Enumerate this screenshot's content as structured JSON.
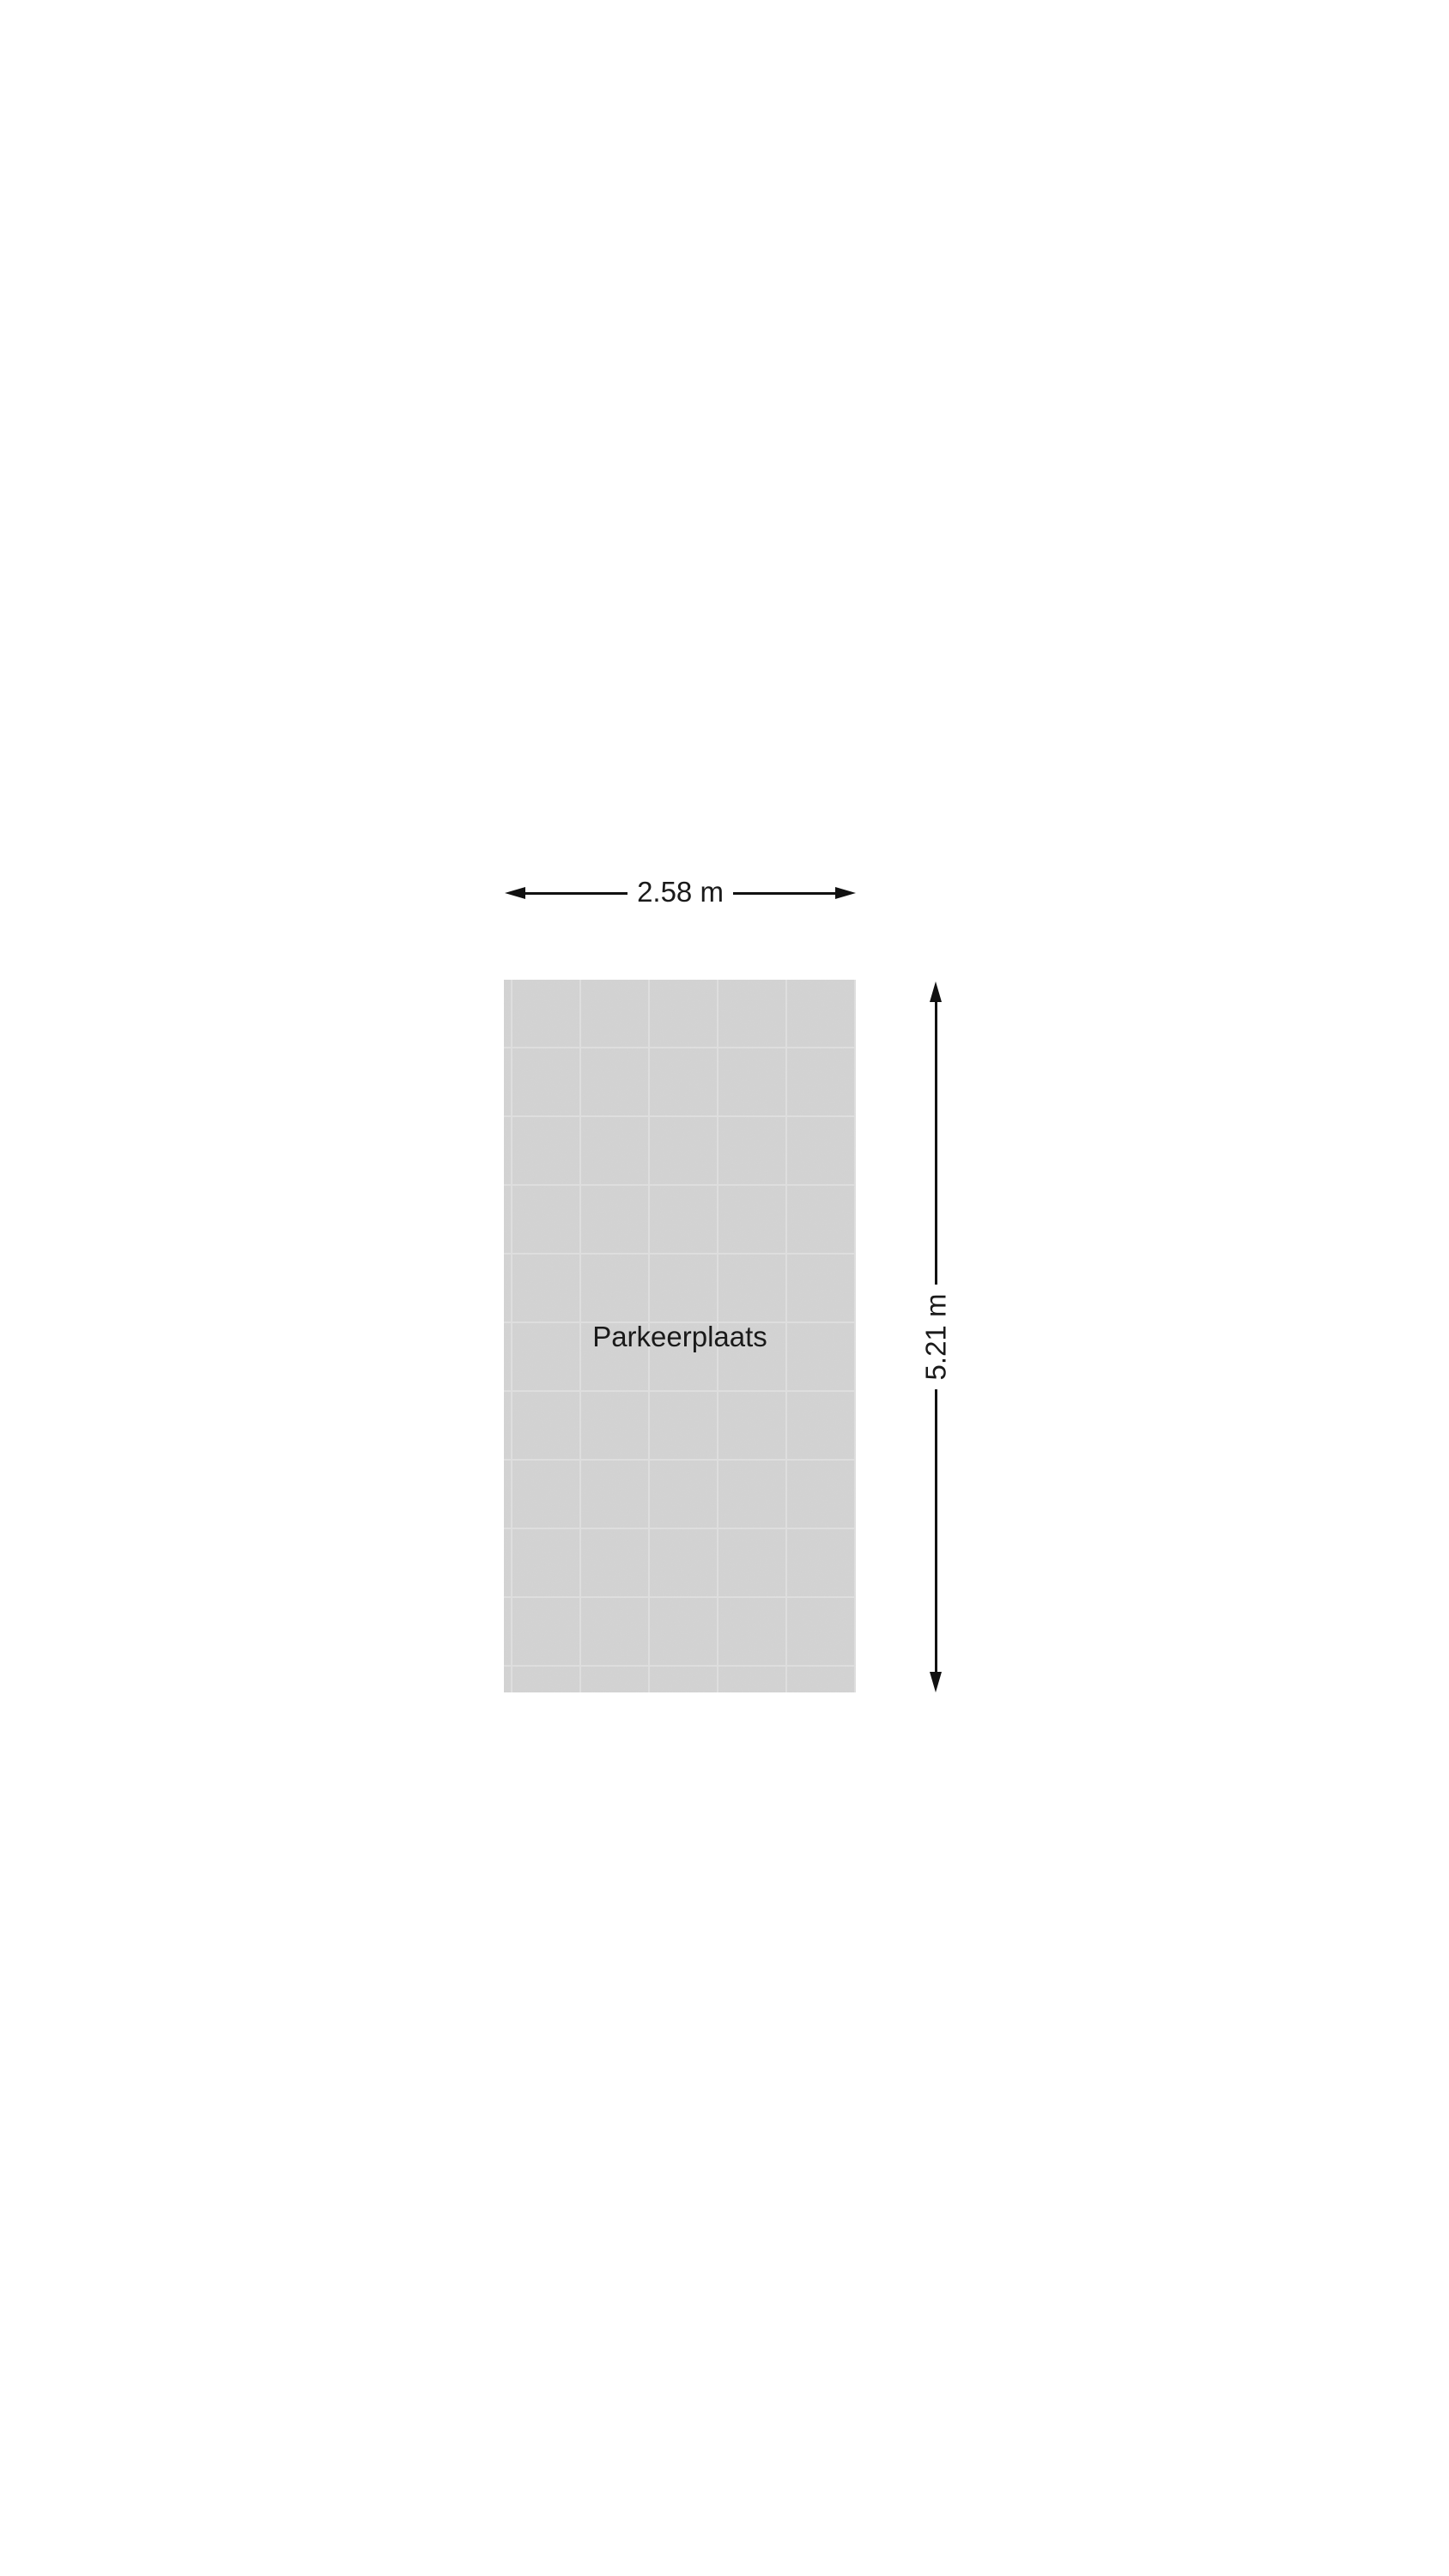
{
  "floorplan": {
    "room_label": "Parkeerplaats",
    "width_dimension_label": "2.58 m",
    "height_dimension_label": "5.21 m",
    "colors": {
      "background": "#ffffff",
      "tile_fill": "#d3d3d3",
      "tile_grid_line": "#dfdfdf",
      "dimension_line": "#111111",
      "text": "#1a1a1a"
    }
  }
}
